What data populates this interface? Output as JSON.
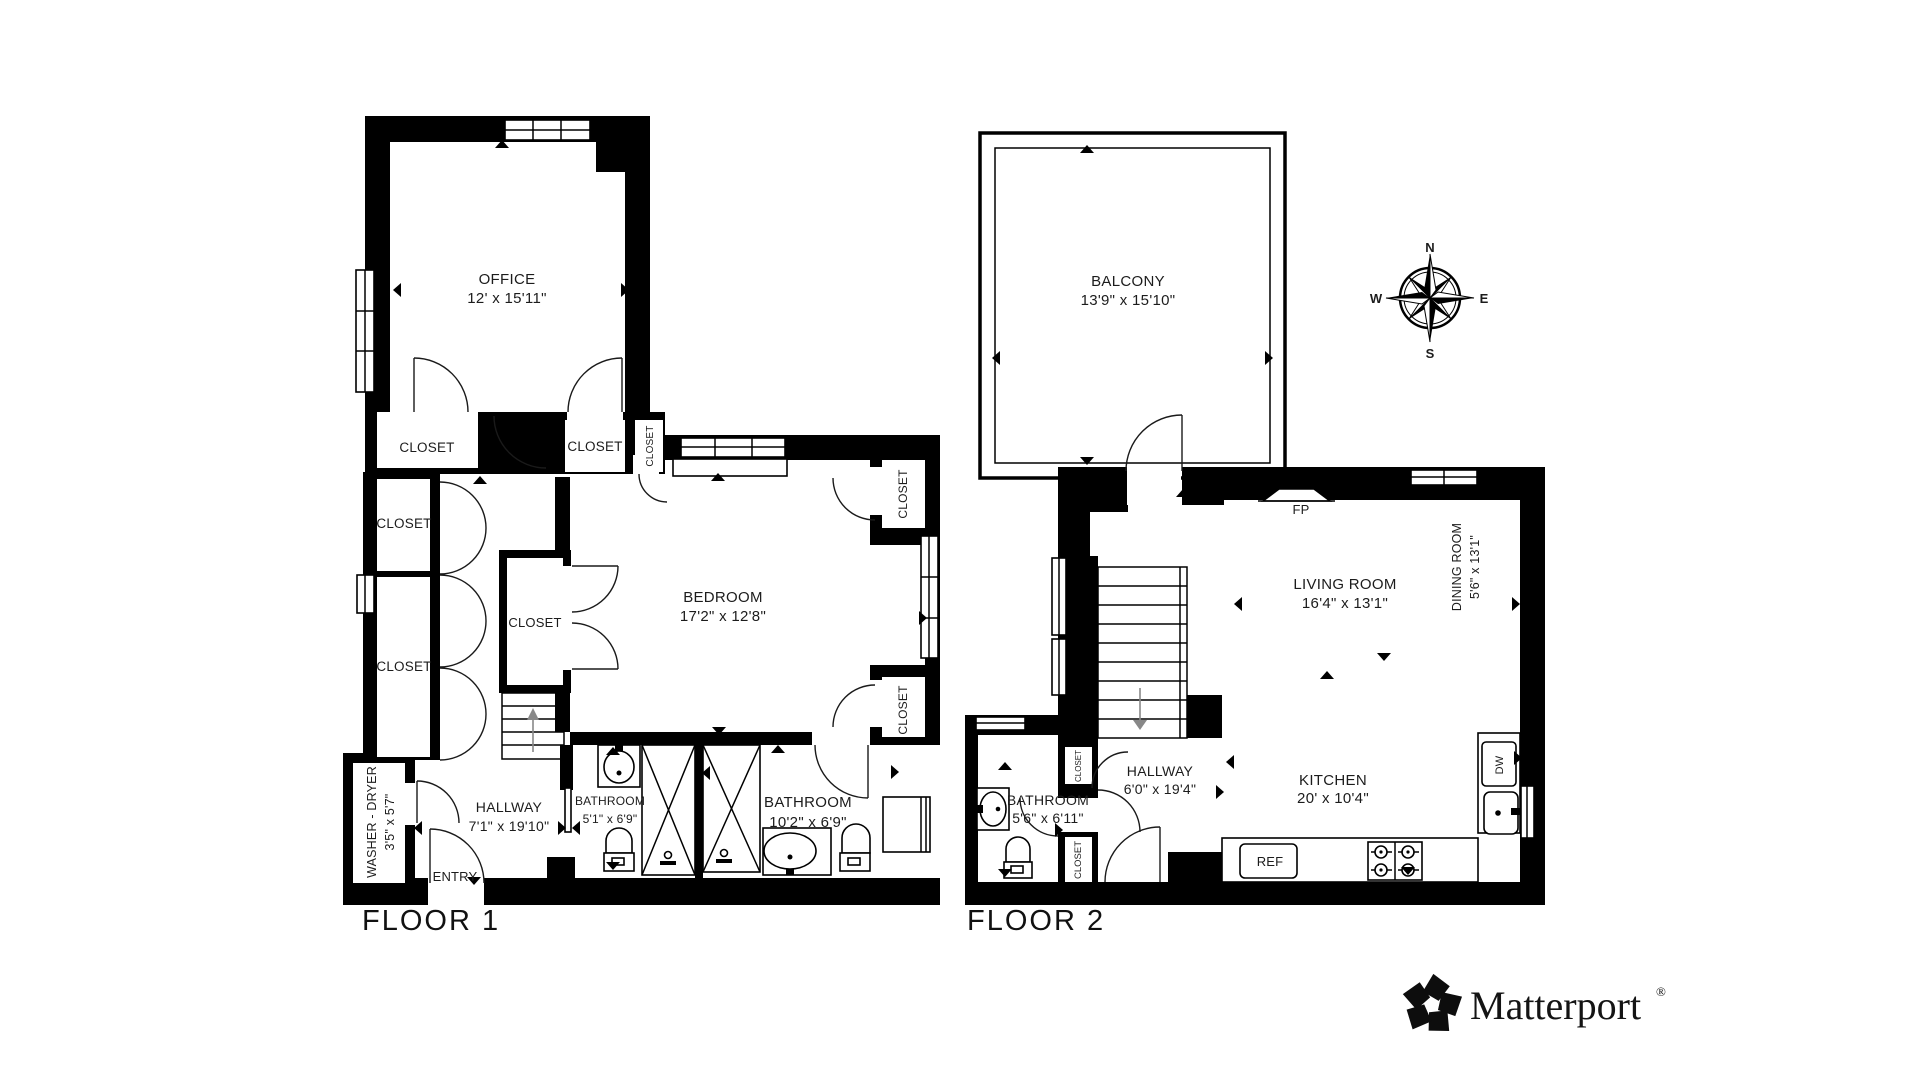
{
  "floor1": {
    "title": "FLOOR 1",
    "office": {
      "name": "OFFICE",
      "dims": "12' x 15'11\""
    },
    "closet_a": {
      "name": "CLOSET"
    },
    "closet_b": {
      "name": "CLOSET"
    },
    "closet_c": {
      "name": "CLOSET"
    },
    "closet_d": {
      "name": "CLOSET"
    },
    "closet_e": {
      "name": "CLOSET"
    },
    "closet_f": {
      "name": "CLOSET"
    },
    "bedroom": {
      "name": "BEDROOM",
      "dims": "17'2\" x 12'8\""
    },
    "closet_g": {
      "name": "CLOSET"
    },
    "closet_h": {
      "name": "CLOSET"
    },
    "washer_dryer": {
      "name": "WASHER - DRYER",
      "dims": "3'5\" x 5'7\""
    },
    "hallway": {
      "name": "HALLWAY",
      "dims": "7'1\" x 19'10\""
    },
    "bathroom_small": {
      "name": "BATHROOM",
      "dims": "5'1\" x 6'9\""
    },
    "bathroom_large": {
      "name": "BATHROOM",
      "dims": "10'2\" x 6'9\""
    },
    "entry": {
      "name": "ENTRY"
    }
  },
  "floor2": {
    "title": "FLOOR 2",
    "balcony": {
      "name": "BALCONY",
      "dims": "13'9\" x 15'10\""
    },
    "fireplace": {
      "name": "FP"
    },
    "living_room": {
      "name": "LIVING ROOM",
      "dims": "16'4\" x 13'1\""
    },
    "dining_room": {
      "name": "DINING ROOM",
      "dims": "5'6\" x 13'1\""
    },
    "hallway": {
      "name": "HALLWAY",
      "dims": "6'0\" x 19'4\""
    },
    "bathroom": {
      "name": "BATHROOM",
      "dims": "5'6\" x 6'11\""
    },
    "kitchen": {
      "name": "KITCHEN",
      "dims": "20' x 10'4\""
    },
    "closet_upper": {
      "name": "CLOSET"
    },
    "closet_lower": {
      "name": "CLOSET"
    },
    "dishwasher": {
      "name": "DW"
    },
    "refrigerator": {
      "name": "REF"
    }
  },
  "compass": {
    "north": "N",
    "east": "E",
    "south": "S",
    "west": "W"
  },
  "branding": {
    "logo_text": "Matterport",
    "registered_mark": "®"
  },
  "colors": {
    "wall": "#000000",
    "floor": "#ffffff",
    "text": "#1c1c1c"
  }
}
